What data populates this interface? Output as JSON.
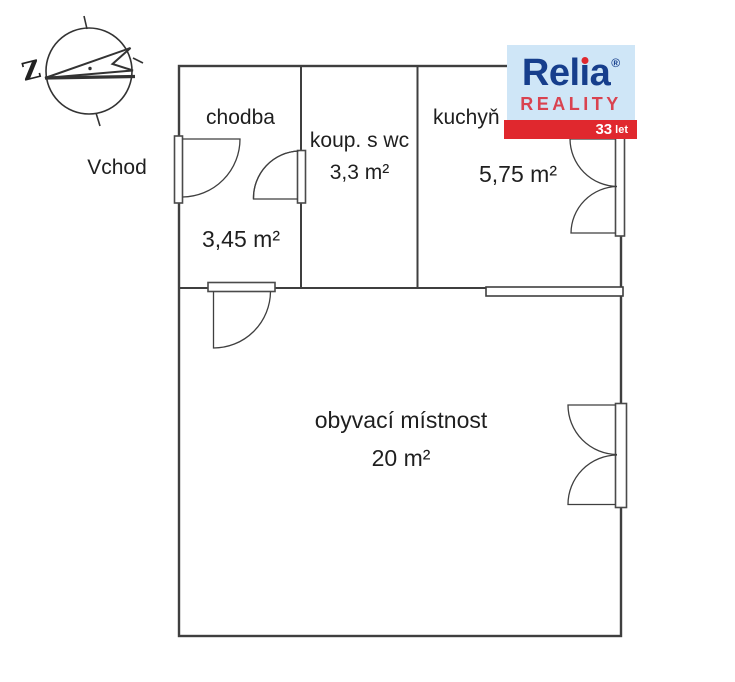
{
  "logo": {
    "brand": "Relia",
    "brand_pre": "Rel",
    "brand_i": "ı",
    "brand_post": "a",
    "registered_mark": "®",
    "subtitle": "REALITY",
    "badge_number": "33",
    "badge_unit": "let",
    "colors": {
      "box_bg": "#cfe6f7",
      "brand_navy": "#163e8c",
      "accent_red": "#e0282e",
      "subtitle_red": "#d94350"
    }
  },
  "compass": {
    "west_label": "Z"
  },
  "labels": {
    "entrance": "Vchod"
  },
  "rooms": [
    {
      "name": "chodba",
      "area": "3,45 m²"
    },
    {
      "name": "koup. s wc",
      "area": "3,3 m²"
    },
    {
      "name": "kuchyň",
      "area": "5,75 m²"
    },
    {
      "name": "obyvací místnost",
      "area": "20 m²"
    }
  ],
  "plan": {
    "line_color": "#3f3f3f"
  }
}
